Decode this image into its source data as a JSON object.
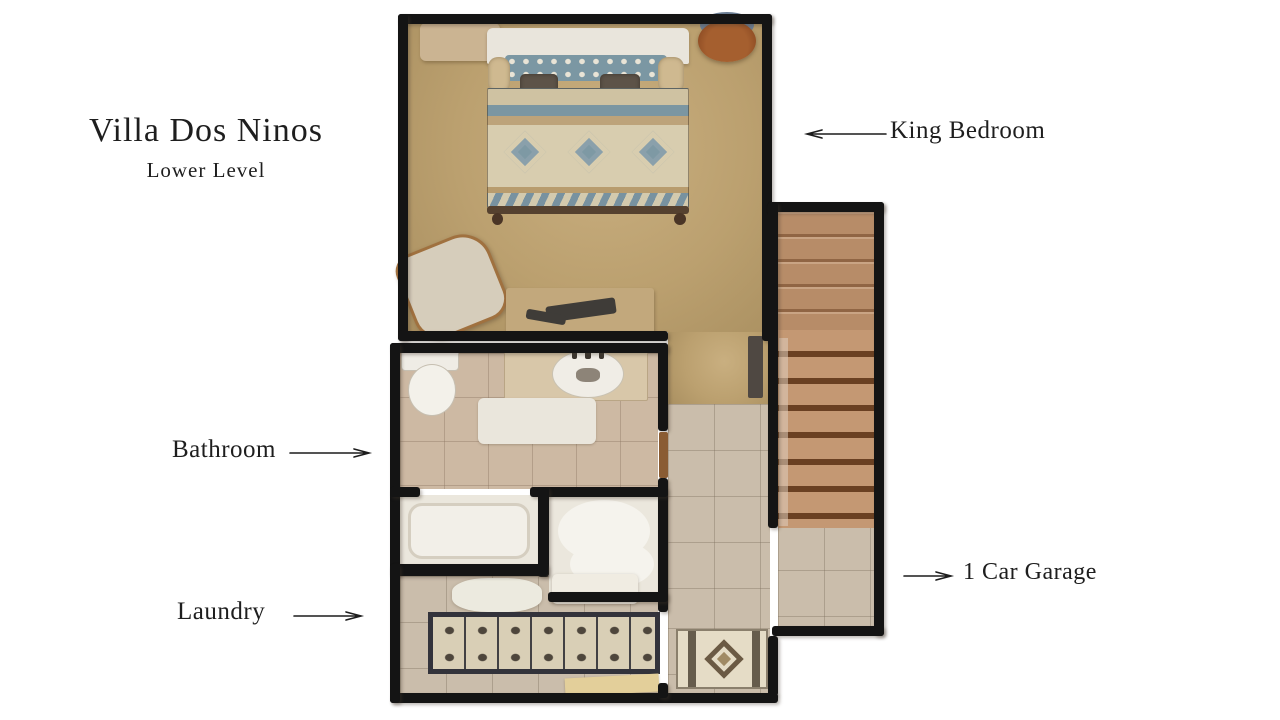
{
  "title": {
    "name": "Villa Dos Ninos",
    "subtitle": "Lower Level"
  },
  "labels": {
    "king_bedroom": "King Bedroom",
    "bathroom": "Bathroom",
    "laundry": "Laundry",
    "garage": "1 Car Garage"
  },
  "colors": {
    "wall": "#141414",
    "carpet": "#bba073",
    "tile": "#cabdab",
    "bathtile": "#cdb9a3",
    "wood": "#b78a66",
    "teal": "#7b97a3",
    "cream": "#d8cdaf",
    "text": "#1e1e1e",
    "bg": "#ffffff"
  }
}
